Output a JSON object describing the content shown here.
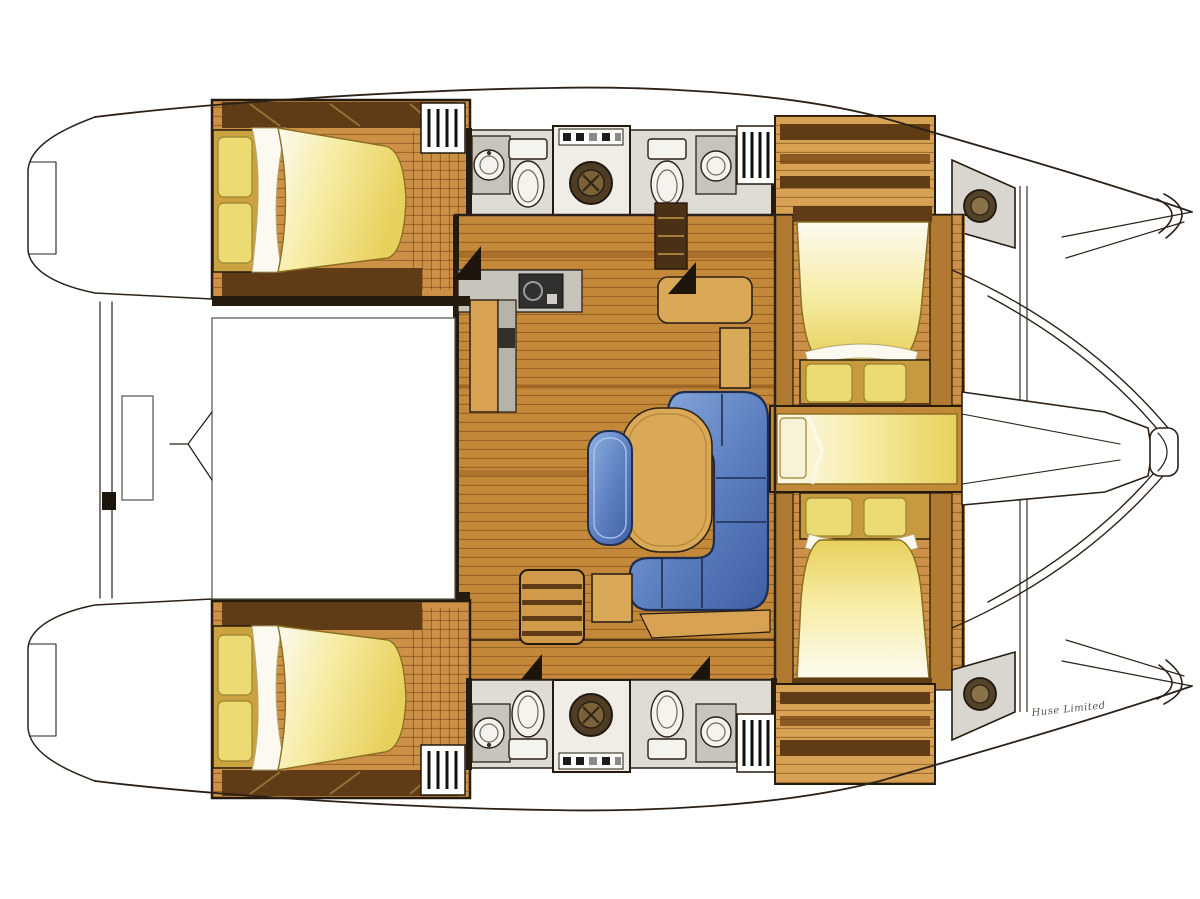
{
  "boat": {
    "kind": "catamaran-interior-floor-plan",
    "view": "top-down",
    "bow_direction": "right",
    "hulls": 2
  },
  "signature": "Huse Limited",
  "areas": {
    "port_hull": [
      "aft-double-cabin",
      "head-sink-toilet",
      "washing-machine",
      "head-toilet-sink",
      "forward-lockers",
      "bow-vanity"
    ],
    "starboard_hull": [
      "aft-double-cabin",
      "head-sink-toilet",
      "washing-machine",
      "head-toilet-sink",
      "forward-lockers",
      "bow-vanity"
    ],
    "bridgedeck": [
      "cockpit",
      "galley-counter-stove",
      "galley-island",
      "dining-table",
      "armchair",
      "u-shaped-sofa",
      "companionway-steps",
      "forward-athwartship-cabin-port",
      "forepeak-single-berth",
      "forward-athwartship-cabin-starboard",
      "anchor-locker-pod",
      "trampoline"
    ]
  },
  "features": {
    "double_beds": 4,
    "single_berths": 1,
    "toilets": 4,
    "sinks": 6,
    "washing_machines": 2,
    "stove": 1,
    "dining_table": 1,
    "sofas": 1,
    "armchairs": 1
  },
  "palette": {
    "background": "#ffffff",
    "line": "#2b2118",
    "wood_salon": "#c4883a",
    "wood_cabin": "#cc9147",
    "wood_trim": "#b07a30",
    "wood_cabinet": "#d7a254",
    "wood_dark": "#5f3c15",
    "wall_dark": "#241a0e",
    "counter_gray": "#c6c4bb",
    "head_floor": "#dedcd4",
    "fixture_white": "#f4f3ee",
    "washer_door": "#4e3d24",
    "bed_cream": "#fcfaf0",
    "bed_light": "#f6eca3",
    "bed_deep": "#e8d05c",
    "pillow": "#ecdb72",
    "sofa_light": "#8fb0e0",
    "sofa_mid": "#5b7fc0",
    "sofa_dark": "#3f5fa5",
    "sofa_stroke": "#1e2e50",
    "table_tan": "#d9a958",
    "signature_ink": "#5a564e"
  }
}
